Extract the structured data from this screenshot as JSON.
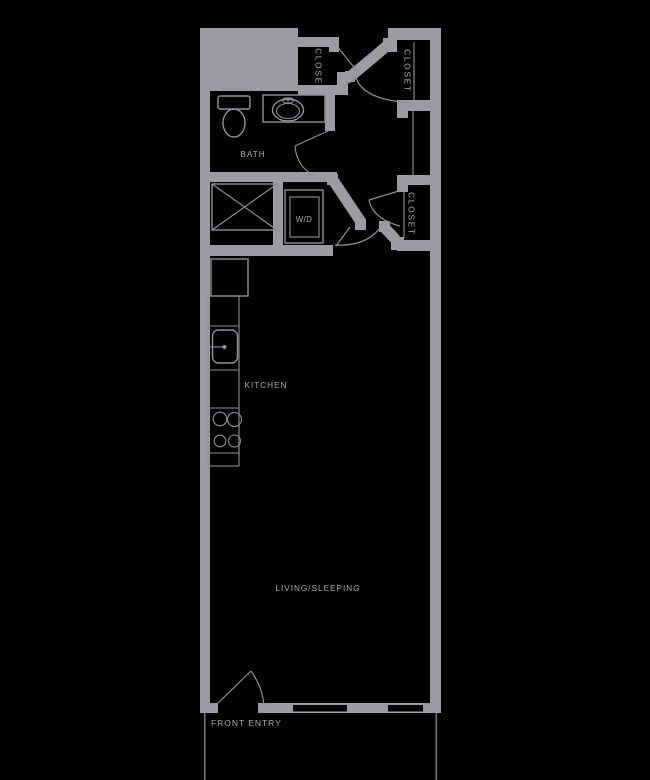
{
  "figure": "studio-apartment-floor-plan",
  "colors": {
    "background": "#010102",
    "wall": "#9b9ca3",
    "line": "#8f9199",
    "line_dim": "#74767e",
    "text": "#a9abb2"
  },
  "labels": {
    "bath": "BATH",
    "closet_top_left": "CLOSET",
    "closet_top_right": "CLOSET",
    "closet_mid_right": "CLOSET",
    "washer_dryer": "W/D",
    "kitchen": "KITCHEN",
    "living_sleeping": "LIVING/SLEEPING",
    "front_entry": "FRONT ENTRY"
  },
  "fixtures": [
    "toilet",
    "bathroom-sink-vanity",
    "utility-chase-x-box",
    "washer-dryer-unit",
    "refrigerator",
    "kitchen-counter",
    "kitchen-sink",
    "range-burners",
    "door-swings",
    "windows",
    "patio-boundary-lines"
  ]
}
